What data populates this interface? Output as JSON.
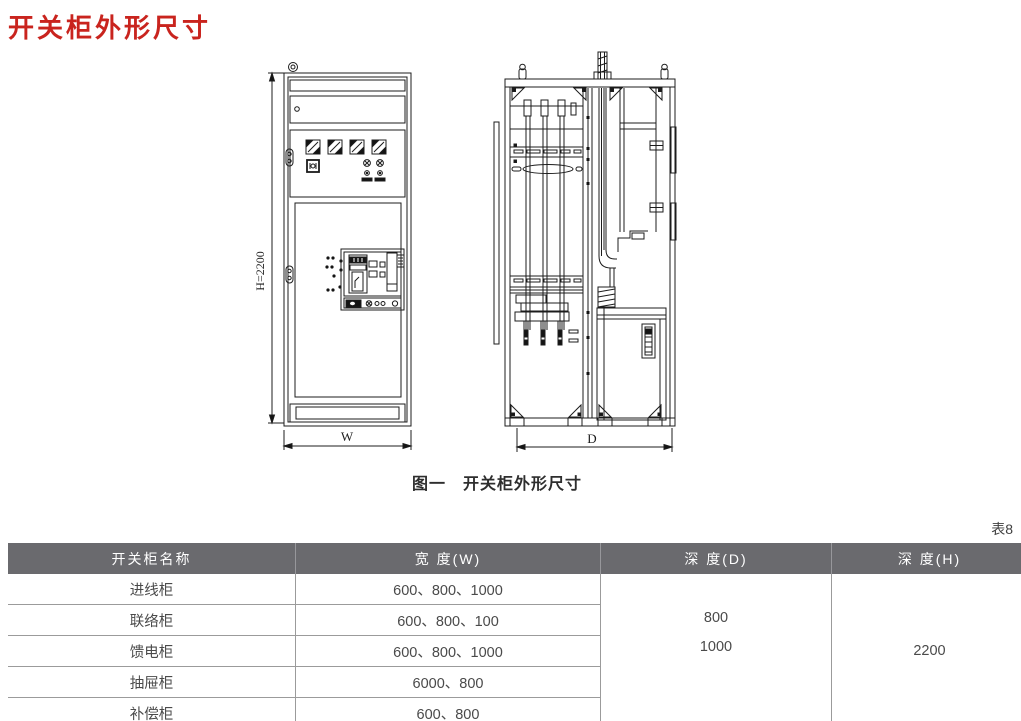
{
  "page": {
    "title": "开关柜外形尺寸",
    "figure_caption": "图一　开关柜外形尺寸",
    "table_label": "表8"
  },
  "figure": {
    "front_view": {
      "height_dim": "H=2200",
      "width_dim": "W"
    },
    "side_view": {
      "depth_dim": "D"
    }
  },
  "colors": {
    "title_red": "#c9241e",
    "table_header_bg": "#6a6a6e",
    "table_header_text": "#ffffff",
    "table_body_text": "#4a4a4a",
    "table_grid": "#9b9b9b",
    "drawing_line": "#1c1c1c"
  },
  "table": {
    "headers": [
      "开关柜名称",
      "宽 度(W)",
      "深 度(D)",
      "深 度(H)"
    ],
    "rows": [
      {
        "name": "进线柜",
        "width": "600、800、1000"
      },
      {
        "name": "联络柜",
        "width": "600、800、100"
      },
      {
        "name": "馈电柜",
        "width": "600、800、1000"
      },
      {
        "name": "抽屉柜",
        "width": "6000、800"
      },
      {
        "name": "补偿柜",
        "width": "600、800"
      }
    ],
    "depth_d": [
      "800",
      "1000"
    ],
    "height_h": "2200"
  }
}
